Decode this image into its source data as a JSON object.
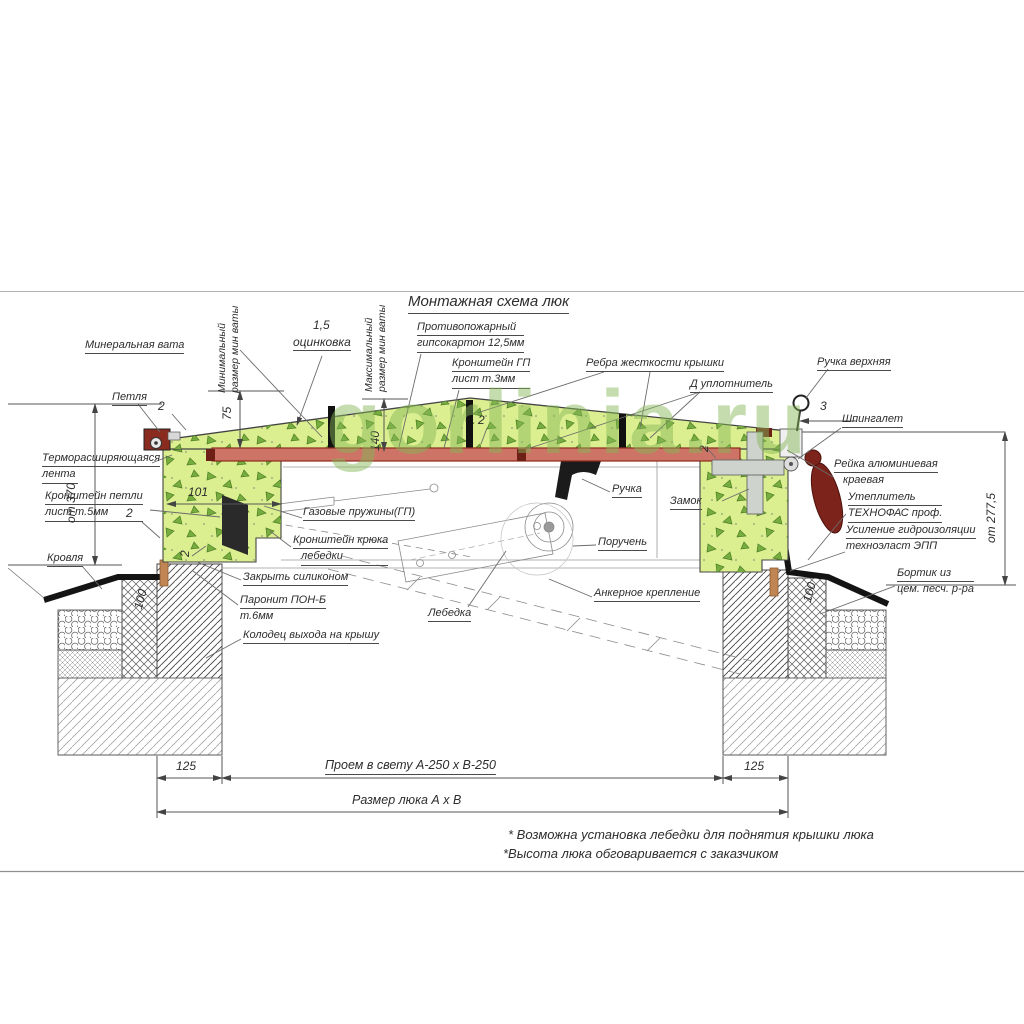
{
  "title": "Монтажная схема люк",
  "watermark": "gorlinia.ru",
  "labels": {
    "mineral_wool": "Минеральная вата",
    "hinge": "Петля",
    "thermo_tape": [
      "Терморасширяющаяся",
      "лента"
    ],
    "hinge_bracket": [
      "Кронштейн петли",
      "лист т.5мм"
    ],
    "roof": "Кровля",
    "min_wool": [
      "Минимальный",
      "размер мин ваты"
    ],
    "max_wool": [
      "Максимальный",
      "размер мин ваты"
    ],
    "zinc_value": "1,5",
    "zinc": "оцинковка",
    "fire_gypsum": [
      "Противопожарный",
      "гипсокартон 12,5мм"
    ],
    "gp_bracket": [
      "Кронштейн ГП",
      "лист т.3мм"
    ],
    "ribs": "Ребра жесткости крышки",
    "seal": "Д уплотнитель",
    "top_handle": "Ручка верхняя",
    "latch": "Шпингалет",
    "alu_rail": [
      "Рейка алюминиевая",
      "краевая"
    ],
    "insulation": [
      "Утеплитель",
      "ТЕХНОФАС проф."
    ],
    "waterproofing": [
      "Усиление гидроизоляции",
      "техноэласт ЭПП"
    ],
    "curb": [
      "Бортик из",
      "цем. песч. р-ра"
    ],
    "gas_springs": "Газовые пружины(ГП)",
    "hook_bracket": [
      "Кронштейн крюка",
      "лебедки"
    ],
    "handle": "Ручка",
    "lock": "Замок",
    "handrail": "Поручень",
    "winch": "Лебедка",
    "anchor": "Анкерное крепление",
    "silicone": "Закрыть силиконом",
    "paronite": [
      "Паронит ПОН-Б",
      "т.6мм"
    ],
    "shaft": "Колодец выхода на крышу"
  },
  "dimensions": {
    "height_left": "от 370",
    "height_right": "от 277,5",
    "wool_min": "75",
    "wool_max": "140",
    "frame_width": "101",
    "curb_left": "100",
    "curb_right": "100",
    "wall_left": "125",
    "wall_right": "125",
    "handle_offset": "3",
    "weld": "2",
    "opening": "Проем в свету А-250 х В-250",
    "hatch_size": "Размер люка А х В"
  },
  "notes": [
    "* Возможна установка лебедки для поднятия крышки люка",
    "*Высота люка обговаривается с заказчиком"
  ],
  "colors": {
    "cover_green": "#dbef90",
    "fireproof_red": "#cd7466",
    "hardware_dark_red": "#7c241c",
    "watermark_green": "#86b757",
    "line_gray": "#555555"
  }
}
